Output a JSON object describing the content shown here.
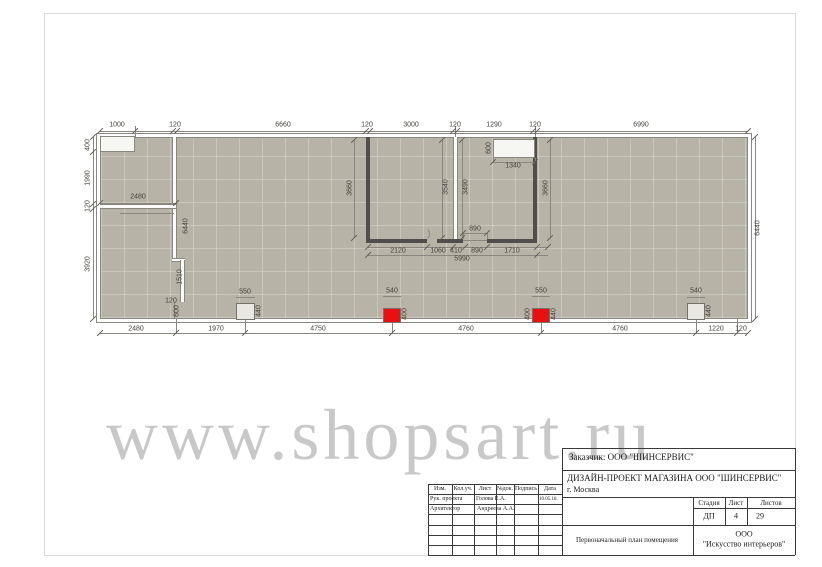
{
  "watermark": {
    "text": "www.shopsart.ru"
  },
  "colors": {
    "floor": "#b7b3a7",
    "dark_wall": "#504e4a",
    "fixture_red": "#ea1010",
    "fixture_grey": "#e9e7e2",
    "dim_text": "#44423c",
    "watermark_grey": "#8c8c8c"
  },
  "plan": {
    "dim_labels": [
      {
        "t": "1000",
        "x": 117,
        "y": 125,
        "r": 0
      },
      {
        "t": "120",
        "x": 175,
        "y": 125,
        "r": 0
      },
      {
        "t": "6660",
        "x": 283,
        "y": 125,
        "r": 0
      },
      {
        "t": "120",
        "x": 367,
        "y": 125,
        "r": 0
      },
      {
        "t": "3000",
        "x": 411,
        "y": 125,
        "r": 0
      },
      {
        "t": "120",
        "x": 455,
        "y": 125,
        "r": 0
      },
      {
        "t": "1290",
        "x": 494,
        "y": 125,
        "r": 0
      },
      {
        "t": "120",
        "x": 535,
        "y": 125,
        "r": 0
      },
      {
        "t": "6990",
        "x": 641,
        "y": 125,
        "r": 0
      },
      {
        "t": "400",
        "x": 88,
        "y": 145,
        "r": 1
      },
      {
        "t": "1990",
        "x": 88,
        "y": 178,
        "r": 1
      },
      {
        "t": "120",
        "x": 88,
        "y": 206,
        "r": 1
      },
      {
        "t": "3920",
        "x": 88,
        "y": 264,
        "r": 1
      },
      {
        "t": "6440",
        "x": 758,
        "y": 228,
        "r": 1
      },
      {
        "t": "2480",
        "x": 138,
        "y": 197,
        "r": 0
      },
      {
        "t": "6440",
        "x": 186,
        "y": 226,
        "r": 1
      },
      {
        "t": "1510",
        "x": 180,
        "y": 277,
        "r": 1
      },
      {
        "t": "120",
        "x": 171,
        "y": 301,
        "r": 0
      },
      {
        "t": "600",
        "x": 177,
        "y": 311,
        "r": 1
      },
      {
        "t": "3660",
        "x": 350,
        "y": 188,
        "r": 1
      },
      {
        "t": "3540",
        "x": 446,
        "y": 187,
        "r": 1
      },
      {
        "t": "3490",
        "x": 466,
        "y": 187,
        "r": 1
      },
      {
        "t": "3660",
        "x": 546,
        "y": 188,
        "r": 1
      },
      {
        "t": "600",
        "x": 489,
        "y": 148,
        "r": 1
      },
      {
        "t": "1340",
        "x": 513,
        "y": 166,
        "r": 0
      },
      {
        "t": "890",
        "x": 475,
        "y": 229,
        "r": 0
      },
      {
        "t": "2120",
        "x": 398,
        "y": 251,
        "r": 0
      },
      {
        "t": "1060",
        "x": 438,
        "y": 251,
        "r": 0
      },
      {
        "t": "410",
        "x": 456,
        "y": 251,
        "r": 0
      },
      {
        "t": "890",
        "x": 477,
        "y": 251,
        "r": 0
      },
      {
        "t": "1710",
        "x": 512,
        "y": 251,
        "r": 0
      },
      {
        "t": "5990",
        "x": 462,
        "y": 259,
        "r": 0
      },
      {
        "t": "2480",
        "x": 136,
        "y": 329,
        "r": 0
      },
      {
        "t": "1970",
        "x": 216,
        "y": 329,
        "r": 0
      },
      {
        "t": "4750",
        "x": 318,
        "y": 329,
        "r": 0
      },
      {
        "t": "4760",
        "x": 466,
        "y": 329,
        "r": 0
      },
      {
        "t": "4760",
        "x": 620,
        "y": 329,
        "r": 0
      },
      {
        "t": "1220",
        "x": 716,
        "y": 329,
        "r": 0
      },
      {
        "t": "120",
        "x": 741,
        "y": 329,
        "r": 0
      },
      {
        "t": "550",
        "x": 245,
        "y": 292,
        "r": 0
      },
      {
        "t": "440",
        "x": 259,
        "y": 311,
        "r": 1
      },
      {
        "t": "540",
        "x": 392,
        "y": 291,
        "r": 0
      },
      {
        "t": "400",
        "x": 405,
        "y": 314,
        "r": 1
      },
      {
        "t": "550",
        "x": 541,
        "y": 291,
        "r": 0
      },
      {
        "t": "400",
        "x": 528,
        "y": 314,
        "r": 1
      },
      {
        "t": "440",
        "x": 554,
        "y": 314,
        "r": 1
      },
      {
        "t": "540",
        "x": 696,
        "y": 291,
        "r": 0
      },
      {
        "t": "440",
        "x": 709,
        "y": 311,
        "r": 1
      }
    ]
  },
  "title_block": {
    "customer": "Заказчик:  ООО \"ШИНСЕРВИС\"",
    "project_line1": "ДИЗАЙН-ПРОЕКТ МАГАЗИНА  ООО \"ШИНСЕРВИС\"",
    "project_line2": "г. Москва",
    "header_cols": [
      "Изм.",
      "Кол.уч.",
      "Лист",
      "№док.",
      "Подпись",
      "Дата"
    ],
    "row1_role": "Рук. проекта",
    "row1_name": "Голова Е.А.",
    "row1_date": "10.05.18.",
    "row2_role": "Архитектор",
    "row2_name": "Андреева А.А.",
    "stage_header": [
      "Стадия",
      "Лист",
      "Листов"
    ],
    "stage_values": [
      "ДП",
      "4",
      "29"
    ],
    "doc_name": "Первоначальный план помещения",
    "company_line1": "ООО",
    "company_line2": "\"Искусство интерьеров\""
  }
}
